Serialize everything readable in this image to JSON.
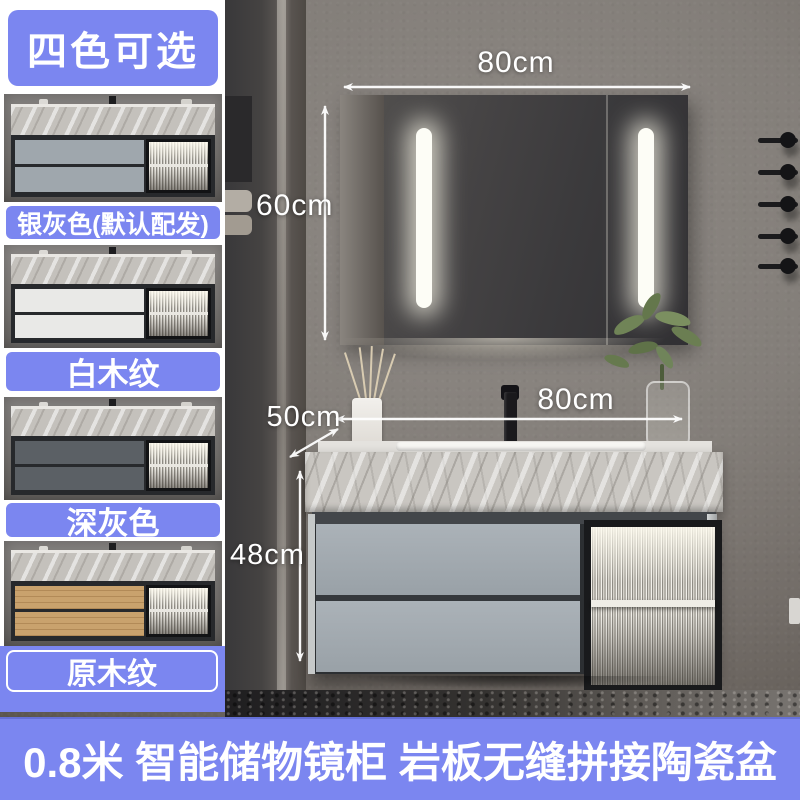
{
  "badge": {
    "label": "四色可选"
  },
  "variants": [
    {
      "label": "银灰色(默认配发)",
      "drawer_color": "#9fa7ad"
    },
    {
      "label": "白木纹",
      "drawer_color": "#e9e9e7"
    },
    {
      "label": "深灰色",
      "drawer_color": "#5b6065"
    },
    {
      "label": "原木纹",
      "drawer_color": "#c9a26d"
    }
  ],
  "annotations": {
    "mirror_width": "80cm",
    "mirror_height": "60cm",
    "counter_depth": "50cm",
    "counter_width": "80cm",
    "cabinet_height": "48cm"
  },
  "banner": {
    "text": "0.8米 智能储物镜柜 岩板无缝拼接陶瓷盆"
  },
  "colors": {
    "accent": "#7B86F0",
    "annotation": "#FFFFFF"
  }
}
